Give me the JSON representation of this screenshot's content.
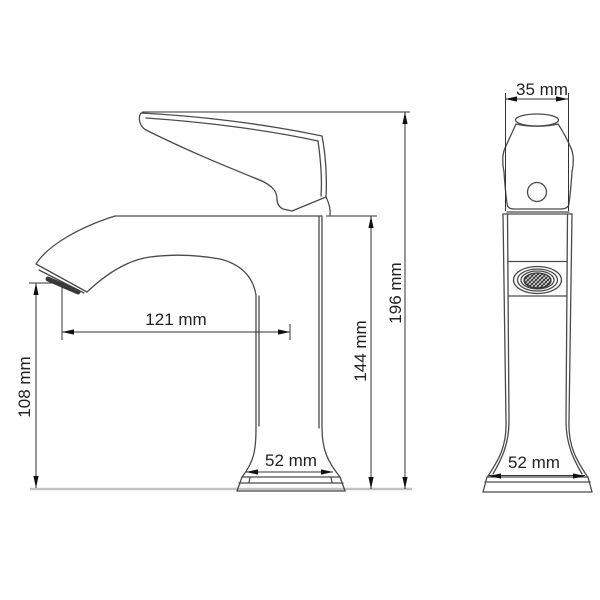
{
  "drawing": {
    "kind": "faucet-dimension-technical-drawing",
    "side_view": {
      "dim_spout_reach": "121 mm",
      "dim_spout_height": "108 mm",
      "dim_body_height": "144 mm",
      "dim_total_height": "196 mm",
      "dim_base_width": "52 mm"
    },
    "front_view": {
      "dim_top_width": "35 mm",
      "dim_base_width": "52 mm"
    },
    "colors": {
      "outline": "#4a4a4a",
      "dimension": "#333333",
      "baseline": "#c2c2c2",
      "text": "#222222"
    }
  }
}
